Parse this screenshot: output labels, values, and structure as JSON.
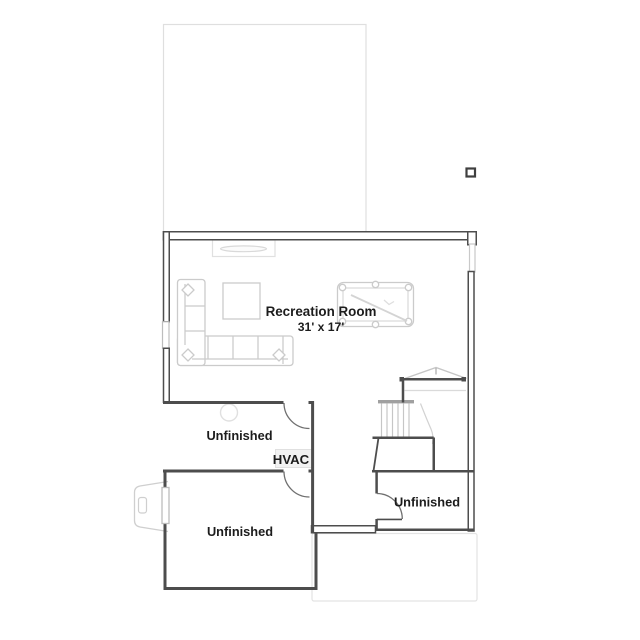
{
  "plan": {
    "labels": {
      "recreation_room_name": "Recreation Room",
      "recreation_room_dimensions": "31' x 17'",
      "unfinished_top": "Unfinished",
      "hvac": "HVAC",
      "unfinished_bottom_left": "Unfinished",
      "unfinished_bottom_right": "Unfinished"
    },
    "colors": {
      "wall": "#4d4d4d",
      "furniture_outline": "#cbcbcb",
      "faint_outline": "#dfdfdf",
      "window_outline": "#bdbdbd",
      "stair_tread_bar": "#a0a0a0",
      "text": "#1c1c1c"
    }
  }
}
